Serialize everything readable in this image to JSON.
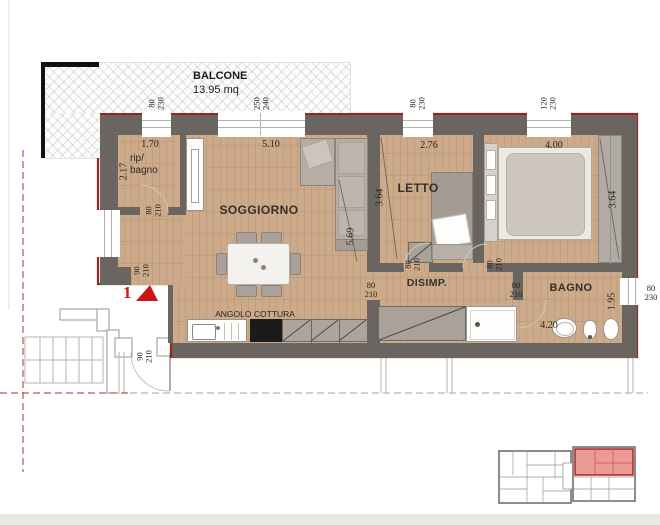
{
  "plan": {
    "balcony": {
      "name": "BALCONE",
      "area": "13.95 mq"
    },
    "unit_marker": "1",
    "rooms": {
      "soggiorno": "SOGGIORNO",
      "letto": "LETTO",
      "disimpegno": "DISIMP.",
      "bagno": "BAGNO",
      "rip_line1": "rip/",
      "rip_line2": "bagno",
      "angolo_cottura": "ANGOLO COTTURA"
    },
    "dimensions": {
      "rip_width": "1.70",
      "rip_depth": "2.17",
      "soggiorno_width": "5.10",
      "soggiorno_depth": "5.69",
      "letto_width": "2.76",
      "letto_depth": "3.64",
      "camera_width": "4.00",
      "camera_depth": "3.64",
      "bagno_length": "4.20",
      "bagno_depth": "1.95"
    },
    "openings": {
      "win_rip": {
        "w": "80",
        "h": "230"
      },
      "balcony_door": {
        "w": "250",
        "h": "240"
      },
      "win_letto": {
        "w": "80",
        "h": "230"
      },
      "win_camera": {
        "w": "120",
        "h": "230"
      },
      "win_bagno": {
        "w": "80",
        "h": "230"
      },
      "door_rip": {
        "w": "80",
        "h": "210"
      },
      "door_notch": {
        "w": "90",
        "h": "210"
      },
      "door_entry": {
        "w": "90",
        "h": "210"
      },
      "door_letto": {
        "w": "80",
        "h": "210"
      },
      "door_camera": {
        "w": "80",
        "h": "210"
      },
      "door_soggiorno": {
        "w": "80",
        "h": "210"
      },
      "door_bagno": {
        "w": "80",
        "h": "210"
      }
    },
    "colors": {
      "wall": "#6a6561",
      "outline_red": "#97251f",
      "wood": "#c9a684",
      "accent_red": "#cc1512",
      "highlight_unit": "#ec9a96"
    }
  }
}
